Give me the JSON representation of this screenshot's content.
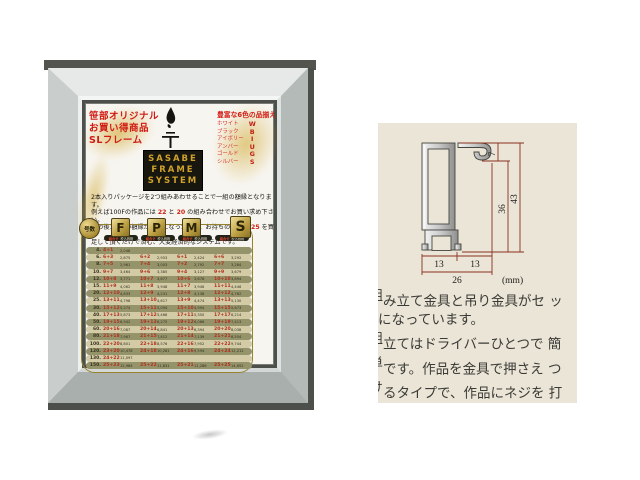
{
  "poster": {
    "promo_lines": [
      "笹部オリジナル",
      "お買い得商品",
      "SLフレーム"
    ],
    "brand_lines": [
      "SASABE",
      "FRAME",
      "SYSTEM"
    ],
    "colors": {
      "header": "豊富な6色の品揃え",
      "names": [
        "ホワイト",
        "ブラック",
        "アイボリー",
        "アンバー",
        "ゴールド",
        "シルバー"
      ],
      "codes": [
        "W",
        "B",
        "I",
        "U",
        "G",
        "S"
      ]
    },
    "intro_lines": [
      [
        {
          "t": "2本入りパッケージを2つ組みあわせることで一組の額縁となります。"
        }
      ],
      [
        {
          "t": "例えば100Fの作品には "
        },
        {
          "t": "22",
          "red": true
        },
        {
          "t": " と "
        },
        {
          "t": "20",
          "red": true
        },
        {
          "t": " の組み合わせでお買い求め下さい。"
        }
      ],
      [
        {
          "t": "その後150Pの額縁が必要になった場合、お持ちの "
        },
        {
          "t": "22",
          "red": true
        },
        {
          "t": " に "
        },
        {
          "t": "25",
          "red": true
        },
        {
          "t": " を買い"
        }
      ],
      [
        {
          "t": "足して頂くだけで済む、大変経済的なシステムです。"
        }
      ]
    ],
    "selector": {
      "circle_label": "号数",
      "letters": [
        "F",
        "P",
        "M",
        "S"
      ]
    },
    "col_header": {
      "left": "組合せ",
      "right": "税込価格"
    },
    "table": {
      "rows": [
        {
          "size": "4.",
          "cells": [
            [
              "4+1",
              "2,048"
            ],
            null,
            null,
            null
          ]
        },
        {
          "size": "6.",
          "cells": [
            [
              "6+3",
              "2,875"
            ],
            [
              "6+2",
              "2,953"
            ],
            [
              "6+1",
              "2,424"
            ],
            [
              "6+6",
              "3,292"
            ]
          ]
        },
        {
          "size": "8.",
          "cells": [
            [
              "7+5",
              "2,961"
            ],
            [
              "7+4",
              "3,003"
            ],
            [
              "7+2",
              "2,792"
            ],
            [
              "7+7",
              "3,284"
            ]
          ]
        },
        {
          "size": "10.",
          "cells": [
            [
              "9+7",
              "3,464"
            ],
            [
              "9+6",
              "3,385"
            ],
            [
              "9+4",
              "3,127"
            ],
            [
              "9+9",
              "3,679"
            ]
          ]
        },
        {
          "size": "12.",
          "cells": [
            [
              "10+8",
              "3,771"
            ],
            [
              "10+7",
              "3,677"
            ],
            [
              "10+6",
              "3,678"
            ],
            [
              "10+10",
              "3,894"
            ]
          ]
        },
        {
          "size": "15.",
          "cells": [
            [
              "11+9",
              "4,062"
            ],
            [
              "11+8",
              "3,948"
            ],
            [
              "11+7",
              "3,946"
            ],
            [
              "11+11",
              "4,446"
            ]
          ]
        },
        {
          "size": "20.",
          "cells": [
            [
              "12+10",
              "4,633"
            ],
            [
              "12+9",
              "4,231"
            ],
            [
              "12+8",
              "4,138"
            ],
            [
              "12+12",
              "4,762"
            ]
          ]
        },
        {
          "size": "25.",
          "cells": [
            [
              "13+11",
              "4,798"
            ],
            [
              "13+10",
              "4,617"
            ],
            [
              "13+9",
              "4,474"
            ],
            [
              "13+13",
              "5,130"
            ]
          ]
        },
        {
          "size": "30.",
          "cells": [
            [
              "15+12",
              "5,274"
            ],
            [
              "15+11",
              "5,094"
            ],
            [
              "15+10",
              "4,994"
            ],
            [
              "15+15",
              "5,673"
            ]
          ]
        },
        {
          "size": "40.",
          "cells": [
            [
              "17+13",
              "5,873"
            ],
            [
              "17+12",
              "5,468"
            ],
            [
              "17+11",
              "5,350"
            ],
            [
              "17+17",
              "6,214"
            ]
          ]
        },
        {
          "size": "50.",
          "cells": [
            [
              "19+15",
              "6,942"
            ],
            [
              "19+13",
              "6,275"
            ],
            [
              "19+12",
              "6,066"
            ],
            [
              "19+19",
              "7,413"
            ]
          ]
        },
        {
          "size": "60.",
          "cells": [
            [
              "20+16",
              "7,087"
            ],
            [
              "20+14",
              "6,841"
            ],
            [
              "20+13",
              "6,394"
            ],
            [
              "20+20",
              "8,038"
            ]
          ]
        },
        {
          "size": "80.",
          "cells": [
            [
              "21+18",
              "7,967"
            ],
            [
              "21+15",
              "7,412"
            ],
            [
              "21+14",
              "7,139"
            ],
            [
              "21+21",
              "8,554"
            ]
          ]
        },
        {
          "size": "100.",
          "cells": [
            [
              "22+20",
              "8,801"
            ],
            [
              "22+18",
              "8,576"
            ],
            [
              "22+16",
              "7,952"
            ],
            [
              "22+22",
              "9,744"
            ]
          ]
        },
        {
          "size": "120.",
          "cells": [
            [
              "23+20",
              "10,478"
            ],
            [
              "24+18",
              "10,281"
            ],
            [
              "24+16",
              "9,594"
            ],
            [
              "24+24",
              "12,212"
            ]
          ]
        },
        {
          "size": "130.",
          "cells": [
            [
              "24+22",
              "11,097"
            ],
            null,
            null,
            null
          ]
        },
        {
          "size": "150.",
          "cells": [
            [
              "25+23",
              "12,984"
            ],
            [
              "25+22",
              "11,831"
            ],
            [
              "25+21",
              "11,286"
            ],
            [
              "25+25",
              "14,652"
            ]
          ]
        }
      ]
    }
  },
  "spec_panel": {
    "dims": {
      "d7": "7",
      "d36": "36",
      "d43": "43",
      "d13a": "13",
      "d13b": "13",
      "d26": "26",
      "unit": "(mm)"
    },
    "description_lines": [
      {
        "frag": "組",
        "text": "み立て金具と吊り金具がセ ッ"
      },
      {
        "frag": "",
        "text": "になっています。"
      },
      {
        "frag": "組",
        "text": "立てはドライバーひとつで 簡"
      },
      {
        "frag": "単",
        "text": "です。作品を金具で押さえ つ"
      },
      {
        "frag": "け",
        "text": "るタイプで、作品にネジを 打"
      },
      {
        "frag": "つ",
        "text": "こともありません。"
      }
    ]
  }
}
